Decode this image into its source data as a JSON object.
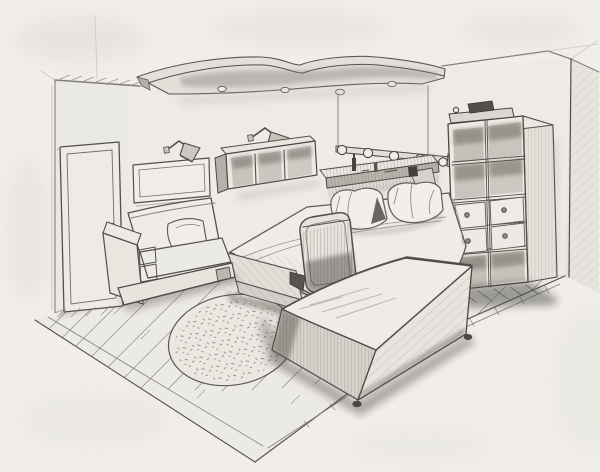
{
  "scene": {
    "medium": "graphite pencil sketch",
    "subject": "bedroom interior in two-point perspective",
    "description": "Hand-drawn pencil sketch of a bedroom interior: a closed door and an empty picture frame on the left wall, a wavy suspended ceiling panel with four round spotlights, two swing-arm wall lamps, a three-compartment wall cube shelf, a double bed with two pillows beneath a headboard shelf and a suspended rail of five round bulbs, a high-back office chair seen from behind, a large storage chest on casters, an oval textured rug on diagonal plank flooring, a boxy armchair with a cushion, and a tall cube shelving unit with four drawers and books on top standing at the right wall corner."
  },
  "palette": {
    "paper": "#f2f0ec",
    "pencil_light": "#b5b1a9",
    "pencil_mid": "#807d77",
    "pencil_dark": "#4c4a45",
    "shadow_dark": "#33312d"
  },
  "objects": {
    "ceiling_panel": "wavy suspended ceiling panel with four round spotlights",
    "door": "closed interior door with round knob",
    "wall_art": "empty rectangular picture frame",
    "wall_lamp_left": "swing-arm wall lamp with cone shade",
    "wall_lamp_right": "swing-arm wall lamp with cone shade",
    "cube_shelf": "wall-mounted shelf with three open compartments",
    "string_lights": "suspended rail with five round bulbs above the bed",
    "headboard_shelf": "headboard shelf with small bottles and jars",
    "bed": "double bed with draped blanket and two pillows",
    "office_chair": "high-back desk chair seen from behind",
    "storage_chest": "large storage chest on casters",
    "rug": "oval stippled rug",
    "armchair": "boxy armchair with seat cushion",
    "shelving_unit": "tall shelving unit with open cubbies, four drawers and books on top",
    "floor": "diagonal plank wood floor with border strip"
  }
}
